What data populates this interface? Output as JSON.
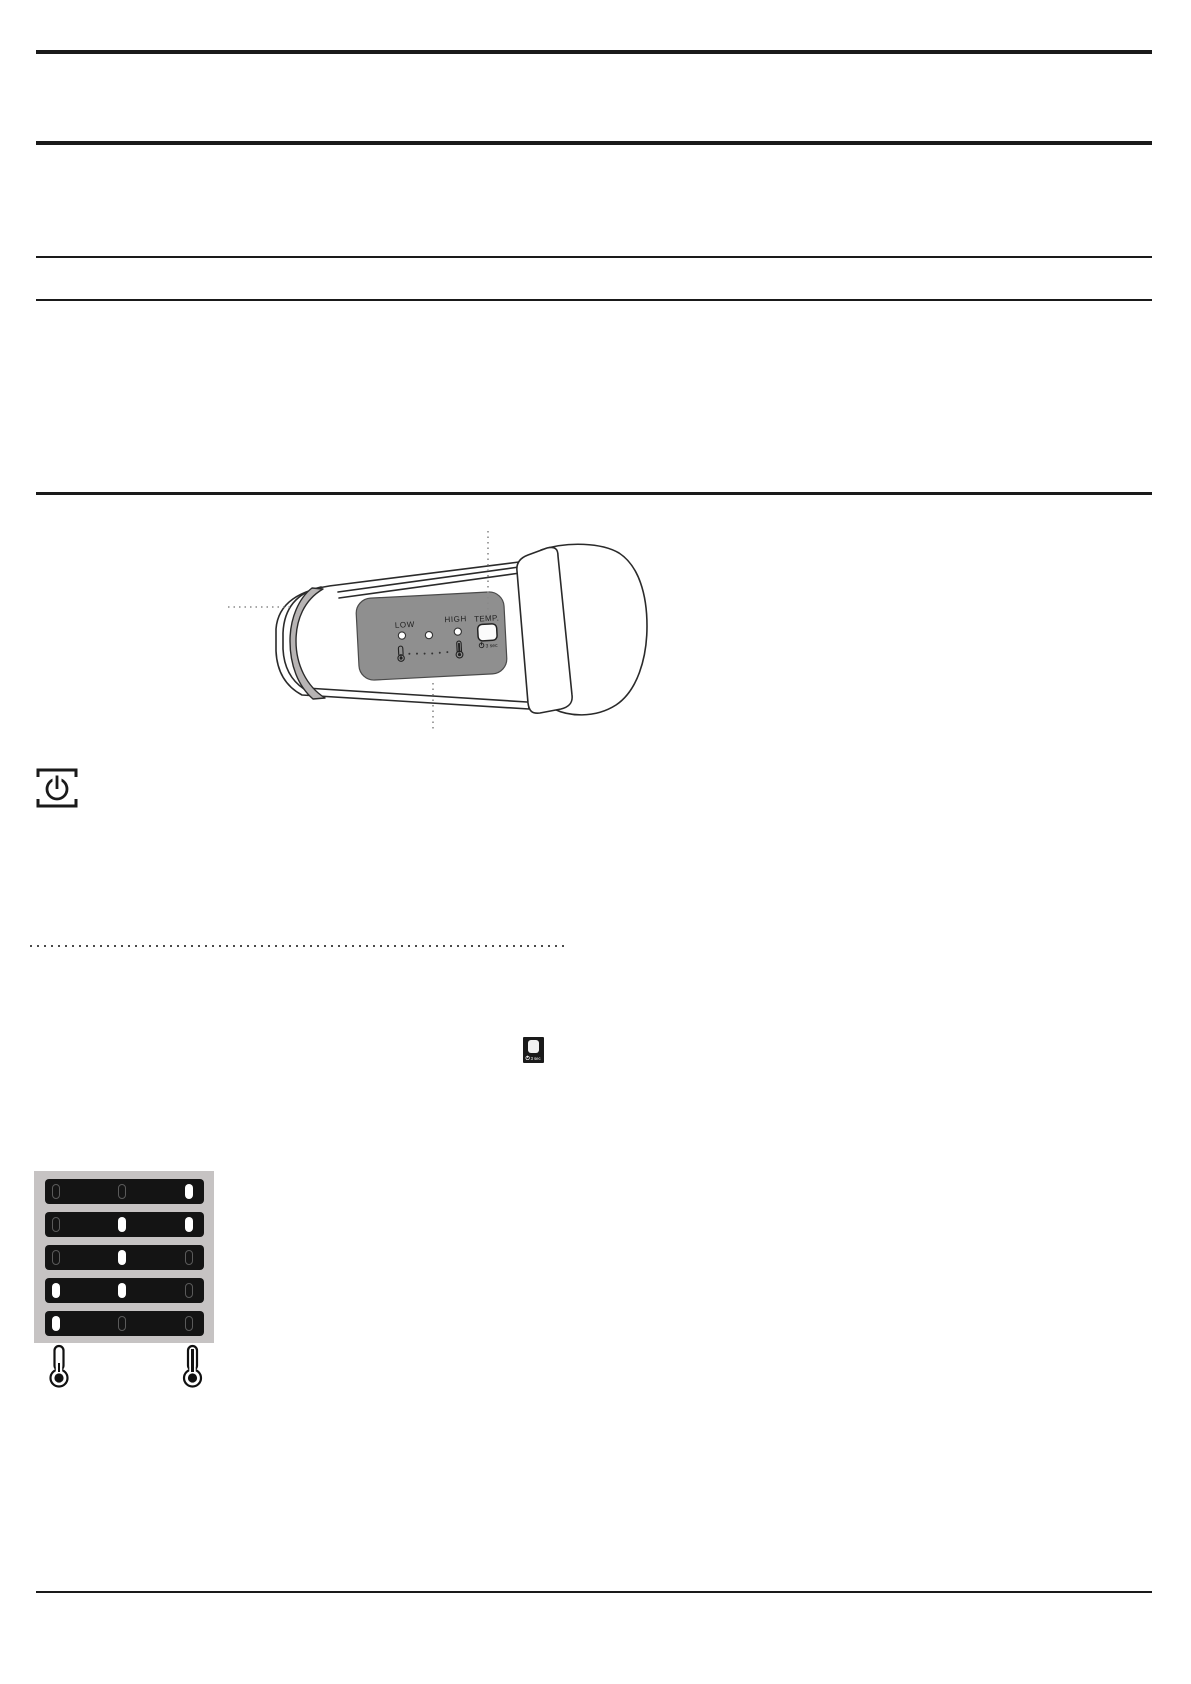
{
  "figure_device": {
    "panel": {
      "low_label": "LOW",
      "high_label": "HIGH",
      "temp_label": "TEMP.",
      "hold_label": "3 sec"
    }
  },
  "mini_temp_button": {
    "hold_label": "3 sec"
  },
  "led_panel": {
    "rows": [
      [
        0,
        0,
        1
      ],
      [
        0,
        1,
        1
      ],
      [
        0,
        1,
        0
      ],
      [
        1,
        1,
        0
      ],
      [
        1,
        0,
        0
      ]
    ]
  },
  "colors": {
    "rule_black": "#1a1a1a",
    "panel_gray": "#8f8f8f",
    "strap_gray": "#b7b4b4",
    "table_gray": "#c6c3c3",
    "row_black": "#141414",
    "led_on": "#ffffff"
  }
}
